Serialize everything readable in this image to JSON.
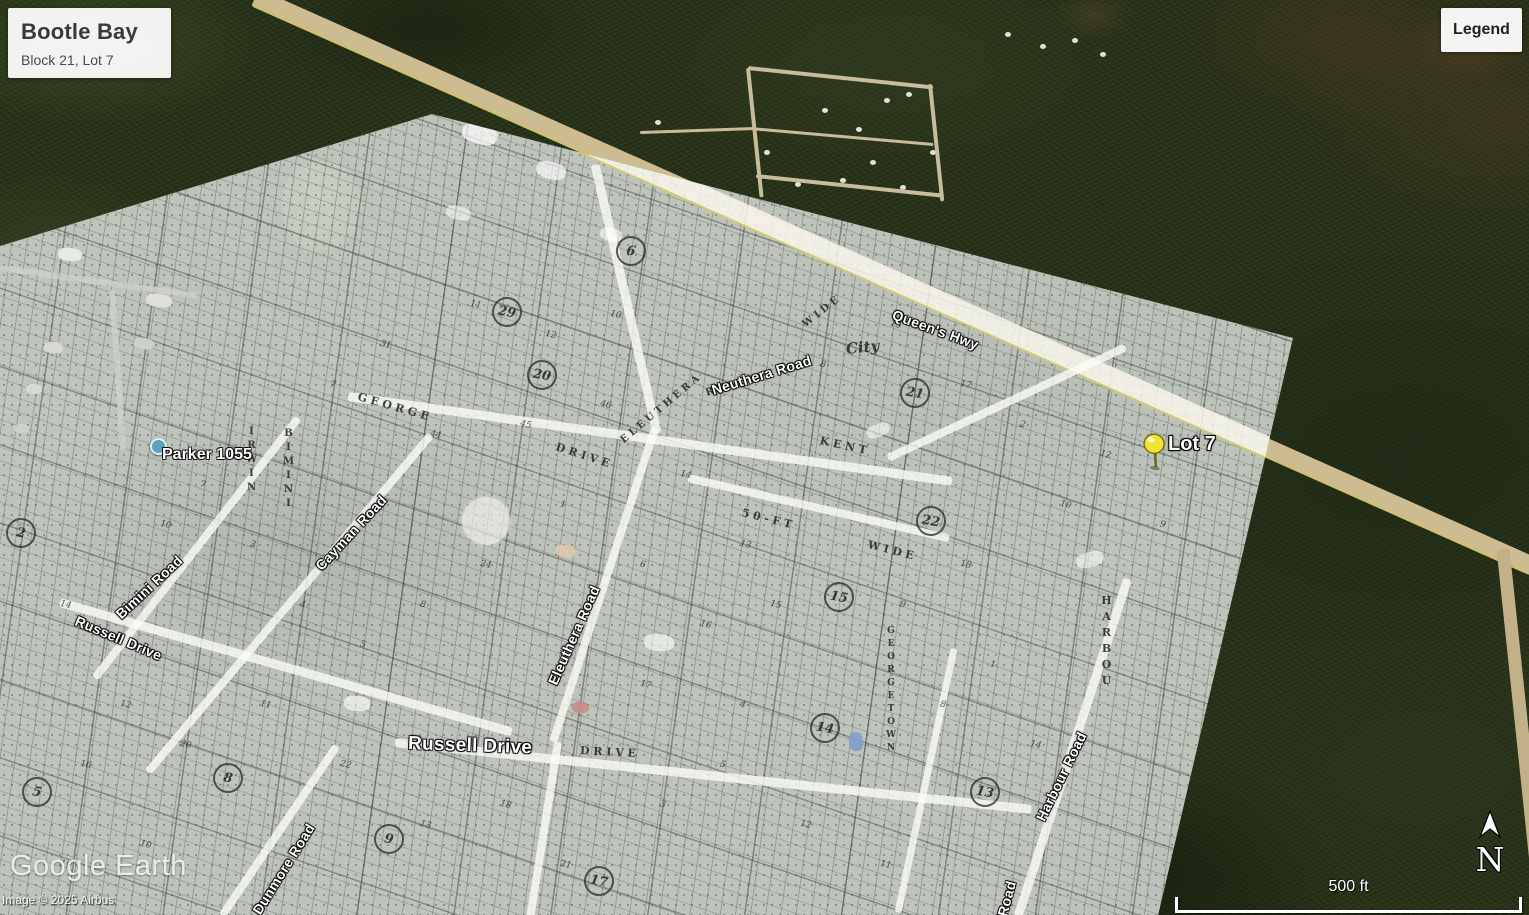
{
  "title_card": {
    "title": "Bootle Bay",
    "subtitle": "Block 21, Lot 7"
  },
  "legend_button": {
    "label": "Legend"
  },
  "watermark": {
    "brand": "Google Earth",
    "copyright": "Image © 2025 Airbus"
  },
  "compass": {
    "label": "N"
  },
  "scale_bar": {
    "label": "500 ft"
  },
  "markers": {
    "pin": {
      "label": "Lot 7",
      "color": "#f2e437"
    },
    "poi": {
      "label": "Parker 1055",
      "color": "#5ba3bd"
    }
  },
  "street_labels": [
    {
      "text": "Queen's Hwy",
      "x": 893,
      "y": 306,
      "rot": 20,
      "size": 14
    },
    {
      "text": "Neuthera Road",
      "x": 712,
      "y": 382,
      "rot": -17,
      "size": 14
    },
    {
      "text": "Cayman Road",
      "x": 318,
      "y": 560,
      "rot": -47,
      "size": 14
    },
    {
      "text": "Bimini Road",
      "x": 118,
      "y": 608,
      "rot": -43,
      "size": 14
    },
    {
      "text": "Russell Drive",
      "x": 76,
      "y": 612,
      "rot": 23,
      "size": 14
    },
    {
      "text": "Eleuthera Road",
      "x": 552,
      "y": 676,
      "rot": -66,
      "size": 14
    },
    {
      "text": "Russell Drive",
      "x": 408,
      "y": 733,
      "rot": 2,
      "size": 19
    },
    {
      "text": "Dunmore Road",
      "x": 256,
      "y": 905,
      "rot": -58,
      "size": 14
    },
    {
      "text": "Harbour Road",
      "x": 1040,
      "y": 812,
      "rot": -64,
      "size": 14
    },
    {
      "text": "Road",
      "x": 1002,
      "y": 908,
      "rot": -75,
      "size": 14
    }
  ],
  "plat_labels": [
    {
      "text": "G E O R G E",
      "x": 358,
      "y": 390,
      "rot": 16,
      "size": 11
    },
    {
      "text": "D R I V E",
      "x": 556,
      "y": 440,
      "rot": 18,
      "size": 11
    },
    {
      "text": "E L E U T H E R A",
      "x": 622,
      "y": 436,
      "rot": -40,
      "size": 10
    },
    {
      "text": "R D",
      "x": 706,
      "y": 388,
      "rot": -20,
      "size": 10
    },
    {
      "text": "5 0 - F T",
      "x": 742,
      "y": 506,
      "rot": 14,
      "size": 11
    },
    {
      "text": "W I D E",
      "x": 868,
      "y": 538,
      "rot": 14,
      "size": 11
    },
    {
      "text": "K E N T",
      "x": 820,
      "y": 434,
      "rot": 12,
      "size": 11
    },
    {
      "text": "D R I V E",
      "x": 580,
      "y": 744,
      "rot": 3,
      "size": 11
    },
    {
      "text": "W I D E",
      "x": 804,
      "y": 320,
      "rot": -38,
      "size": 10
    },
    {
      "text": "City",
      "x": 846,
      "y": 340,
      "rot": -6,
      "size": 15,
      "script": true
    },
    {
      "text": "HARBOU",
      "x": 1100,
      "y": 594,
      "size": 11,
      "stacked": true
    },
    {
      "text": "BIMINI",
      "x": 283,
      "y": 428,
      "size": 10,
      "stacked": true
    },
    {
      "text": "IRWIN",
      "x": 246,
      "y": 426,
      "size": 10,
      "stacked": true
    },
    {
      "text": "GEORGETOWN",
      "x": 886,
      "y": 626,
      "size": 9,
      "stacked": true
    }
  ],
  "block_numbers": [
    {
      "n": "6",
      "x": 616,
      "y": 236
    },
    {
      "n": "29",
      "x": 492,
      "y": 297
    },
    {
      "n": "20",
      "x": 527,
      "y": 360
    },
    {
      "n": "21",
      "x": 900,
      "y": 378
    },
    {
      "n": "22",
      "x": 916,
      "y": 506
    },
    {
      "n": "15",
      "x": 824,
      "y": 582
    },
    {
      "n": "14",
      "x": 810,
      "y": 713
    },
    {
      "n": "13",
      "x": 970,
      "y": 777
    },
    {
      "n": "17",
      "x": 584,
      "y": 866
    },
    {
      "n": "9",
      "x": 374,
      "y": 824
    },
    {
      "n": "8",
      "x": 213,
      "y": 763
    },
    {
      "n": "5",
      "x": 22,
      "y": 777
    },
    {
      "n": "2",
      "x": 6,
      "y": 518
    }
  ],
  "lot_numbers": [
    [
      "11",
      470,
      300
    ],
    [
      "12",
      545,
      330
    ],
    [
      "10",
      610,
      310
    ],
    [
      "31",
      380,
      340
    ],
    [
      "7",
      330,
      380
    ],
    [
      "44",
      430,
      430
    ],
    [
      "45",
      520,
      420
    ],
    [
      "46",
      600,
      400
    ],
    [
      "14",
      680,
      470
    ],
    [
      "13",
      740,
      540
    ],
    [
      "6",
      640,
      560
    ],
    [
      "16",
      700,
      620
    ],
    [
      "15",
      770,
      600
    ],
    [
      "1",
      560,
      500
    ],
    [
      "24",
      480,
      560
    ],
    [
      "8",
      420,
      600
    ],
    [
      "5",
      360,
      640
    ],
    [
      "4",
      300,
      600
    ],
    [
      "3",
      250,
      540
    ],
    [
      "7",
      200,
      480
    ],
    [
      "10",
      160,
      520
    ],
    [
      "12",
      120,
      700
    ],
    [
      "20",
      180,
      740
    ],
    [
      "11",
      260,
      700
    ],
    [
      "22",
      340,
      760
    ],
    [
      "13",
      420,
      820
    ],
    [
      "18",
      500,
      800
    ],
    [
      "21",
      560,
      860
    ],
    [
      "3",
      660,
      800
    ],
    [
      "5",
      720,
      760
    ],
    [
      "12",
      800,
      820
    ],
    [
      "11",
      880,
      860
    ],
    [
      "8",
      940,
      700
    ],
    [
      "9",
      900,
      600
    ],
    [
      "18",
      960,
      560
    ],
    [
      "10",
      1060,
      500
    ],
    [
      "12",
      1100,
      450
    ],
    [
      "9",
      1160,
      520
    ],
    [
      "8",
      820,
      360
    ],
    [
      "15",
      890,
      320
    ],
    [
      "17",
      960,
      380
    ],
    [
      "2",
      1020,
      420
    ],
    [
      "4",
      740,
      700
    ],
    [
      "17",
      640,
      680
    ],
    [
      "14",
      60,
      600
    ],
    [
      "16",
      80,
      760
    ],
    [
      "19",
      60,
      860
    ],
    [
      "10",
      140,
      840
    ],
    [
      "1",
      990,
      660
    ],
    [
      "14",
      1030,
      740
    ]
  ]
}
